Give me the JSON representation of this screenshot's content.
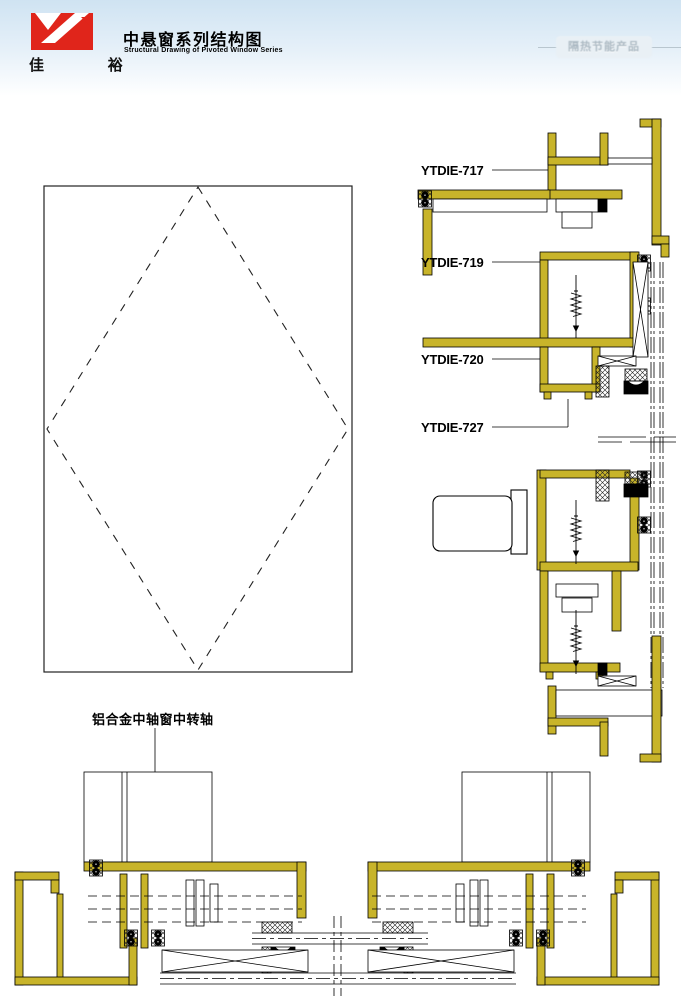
{
  "header": {
    "logo_text": "佳 裕",
    "title_cn": "中悬窗系列结构图",
    "title_en": "Structural Drawing of Pivoted Window Series",
    "watermark_text": "隔热节能产品"
  },
  "colors": {
    "profile_fill": "#c8b42a",
    "logo_red": "#e0251b",
    "header_gradient_top": "#cfe3f2",
    "watermark_gray": "#aab8c2",
    "line_black": "#000000"
  },
  "drawings": {
    "vertical_section_labels": [
      "YTDIE-717",
      "YTDIE-719",
      "YTDIE-720",
      "YTDIE-727"
    ],
    "horizontal_section_label": "铝合金中轴窗中转轴"
  }
}
